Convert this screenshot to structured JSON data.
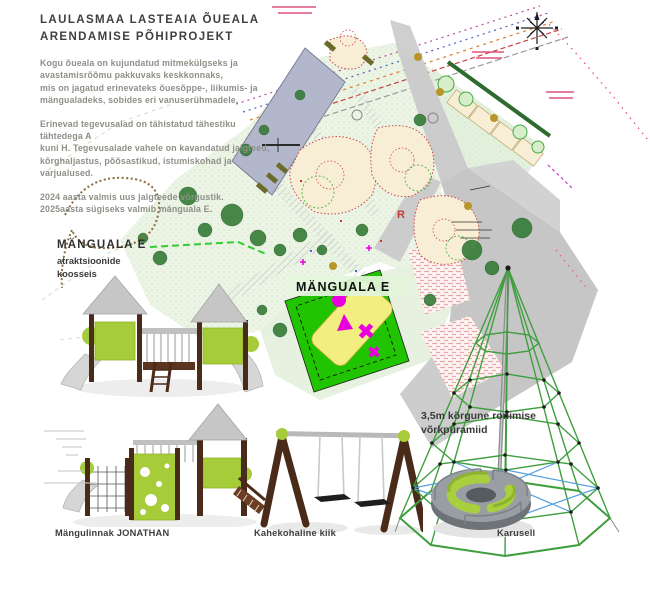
{
  "header": {
    "title": [
      "LAULASMAA LASTEAIA ÕUEALA",
      "ARENDAMISE PÕHIPROJEKT"
    ],
    "paragraph1": [
      "Kogu õueala on kujundatud mitmekülgseks ja",
      "avastamisrõõmu pakkuvaks keskkonnaks,",
      "mis on jagatud erinevateks õuesõppe-, liikumis- ja",
      "mängualadeks, sobides eri vanuserühmadele."
    ],
    "paragraph2": [
      "Erinevad tegevusalad on tähistatud tähestiku tähtedega A",
      "kuni H. Tegevusalade vahele on kavandatud jalgteed,",
      "kõrghaljastus, põõsastikud, istumiskohad ja varjualused."
    ],
    "paragraph3": [
      "2024 aasta valmis uus jalgteede võrgustik.",
      "2025aasta sügiseks valmib mänguala E."
    ]
  },
  "area_callout": {
    "title": "MÄNGUALA E",
    "subtitle": [
      "atraktsioonide",
      "koosseis"
    ]
  },
  "plan": {
    "area_label": "MÄNGUALA E",
    "letter_r": "R"
  },
  "equipment": {
    "castle_label": "Mängulinnak JONATHAN",
    "swing_label": "Kahekohaline kiik",
    "carousel_label": "Karusell",
    "pyramid_label": [
      "3,5m kõrgune ronimise",
      "võrkpüramiid"
    ]
  },
  "colors": {
    "lime": "#a6cc39",
    "wood_brown": "#4a2a18",
    "play_area_green": "#21c400",
    "play_area_yellow": "#f2ee80",
    "shape_magenta": "#e800dd",
    "building": "#b3b7cc",
    "road_gray": "#c9c9c9",
    "grass": "#ebf4e5",
    "label_band": "#e3f5dc",
    "net_green": "#3f9f3f",
    "net_blue": "#55a0dd",
    "boundary_pink": "#e0507a",
    "text_dark": "#3f3f3f",
    "text_gray": "#8f8f88"
  }
}
